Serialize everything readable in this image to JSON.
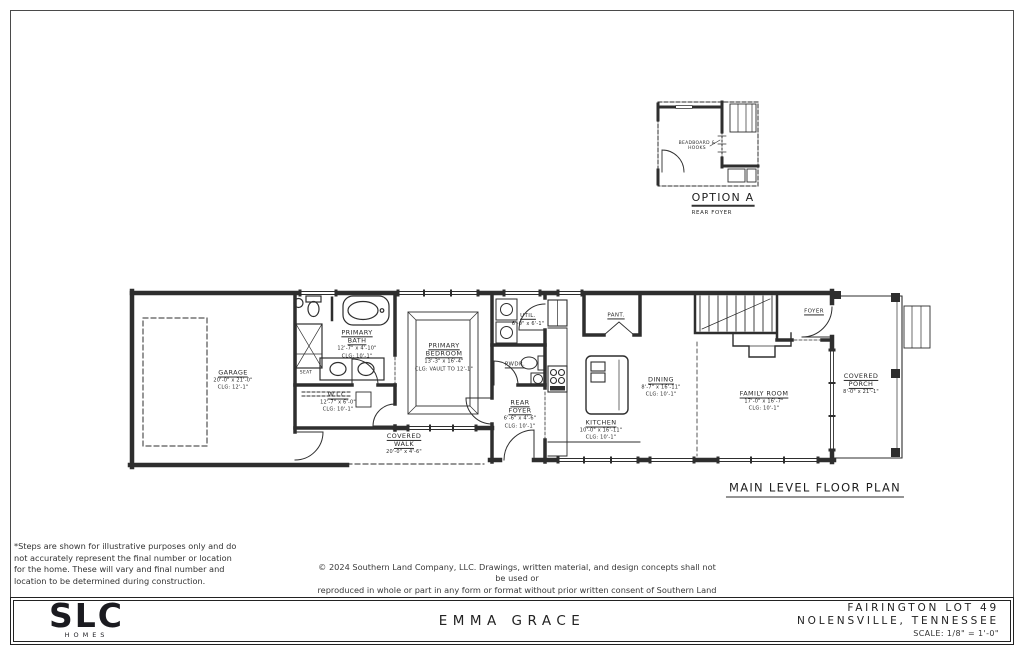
{
  "sheet": {
    "plan_title": "MAIN LEVEL FLOOR PLAN",
    "disclaimer_lines": [
      "*Steps are shown for illustrative purposes only and do",
      "not accurately represent the final number or location",
      "for the home.  These will vary and final number and",
      "location to be determined during construction."
    ],
    "copyright_lines": [
      "© 2024 Southern Land Company, LLC. Drawings, written material, and design concepts shall not be used or",
      "reproduced in whole or part in any form or format without prior written consent of Southern Land Company, LLC."
    ]
  },
  "option_a": {
    "title": "OPTION A",
    "subtitle": "REAR FOYER",
    "note": "BEADBOARD & HOOKS"
  },
  "rooms": {
    "garage": {
      "name": "GARAGE",
      "dims": "20'-0\" x 21'-0\"",
      "clg": "CLG: 12'-1\""
    },
    "primary_bath": {
      "name": "PRIMARY BATH",
      "dims": "12'-7\" x 4'-10\"",
      "clg": "CLG: 10'-1\""
    },
    "seat": {
      "name": "SEAT"
    },
    "wic": {
      "name": "W.I.C.",
      "dims": "12'-7\" x 6'-0\"",
      "clg": "CLG: 10'-1\""
    },
    "primary_bedroom": {
      "name": "PRIMARY BEDROOM",
      "dims": "13'-3\" x 16'-4\"",
      "clg": "CLG: VAULT TO 12'-1\""
    },
    "util": {
      "name": "UTIL.",
      "dims": "6'-0\" x 6'-1\"",
      "clg": ""
    },
    "pwdr": {
      "name": "PWDR.",
      "dims": "",
      "clg": ""
    },
    "rear_foyer": {
      "name": "REAR FOYER",
      "dims": "6'-6\" x 4'-6\"",
      "clg": "CLG: 10'-1\""
    },
    "pant": {
      "name": "PANT.",
      "dims": "",
      "clg": ""
    },
    "kitchen": {
      "name": "KITCHEN",
      "dims": "10'-0\" x 16'-11\"",
      "clg": "CLG: 10'-1\""
    },
    "dining": {
      "name": "DINING",
      "dims": "8'-7\" x 16'-11\"",
      "clg": "CLG: 10'-1\""
    },
    "family_room": {
      "name": "FAMILY ROOM",
      "dims": "17'-0\" x 16'-7\"",
      "clg": "CLG: 10'-1\""
    },
    "foyer": {
      "name": "FOYER",
      "dims": "",
      "clg": ""
    },
    "covered_porch": {
      "name": "COVERED PORCH",
      "dims": "8'-0\" x 21'-1\"",
      "clg": ""
    },
    "covered_walk": {
      "name": "COVERED WALK",
      "dims": "20'-0\" x 4'-6\"",
      "clg": ""
    }
  },
  "title_block": {
    "logo": "SLC",
    "logo_sub": "HOMES",
    "plan_name": "EMMA GRACE",
    "lot": "FAIRINGTON LOT 49",
    "city": "NOLENSVILLE, TENNESSEE",
    "scale": "SCALE: 1/8\" = 1'-0\""
  }
}
